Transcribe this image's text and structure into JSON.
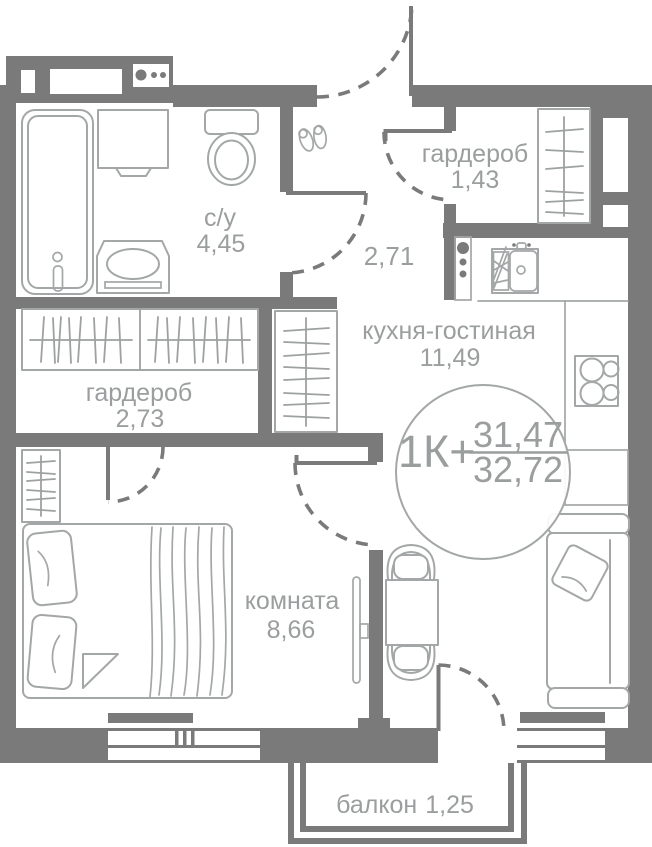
{
  "badge": {
    "type": "1К+",
    "area_upper": "31,47",
    "area_lower": "32,72"
  },
  "rooms": {
    "bathroom": {
      "label": "с/у",
      "area": "4,45"
    },
    "wardrobe_hall": {
      "label": "гардероб",
      "area": "1,43"
    },
    "hallway": {
      "area": "2,71"
    },
    "kitchen_living": {
      "label": "кухня-гостиная",
      "area": "11,49"
    },
    "wardrobe_bedroom": {
      "label": "гардероб",
      "area": "2,73"
    },
    "bedroom": {
      "label": "комната",
      "area": "8,66"
    },
    "balcony": {
      "label": "балкон",
      "area": "1,25"
    }
  },
  "colors": {
    "wall": "#7a7a7a",
    "furniture_line": "#a4a7a7",
    "label_text": "#9b9e9e",
    "background": "#ffffff"
  }
}
